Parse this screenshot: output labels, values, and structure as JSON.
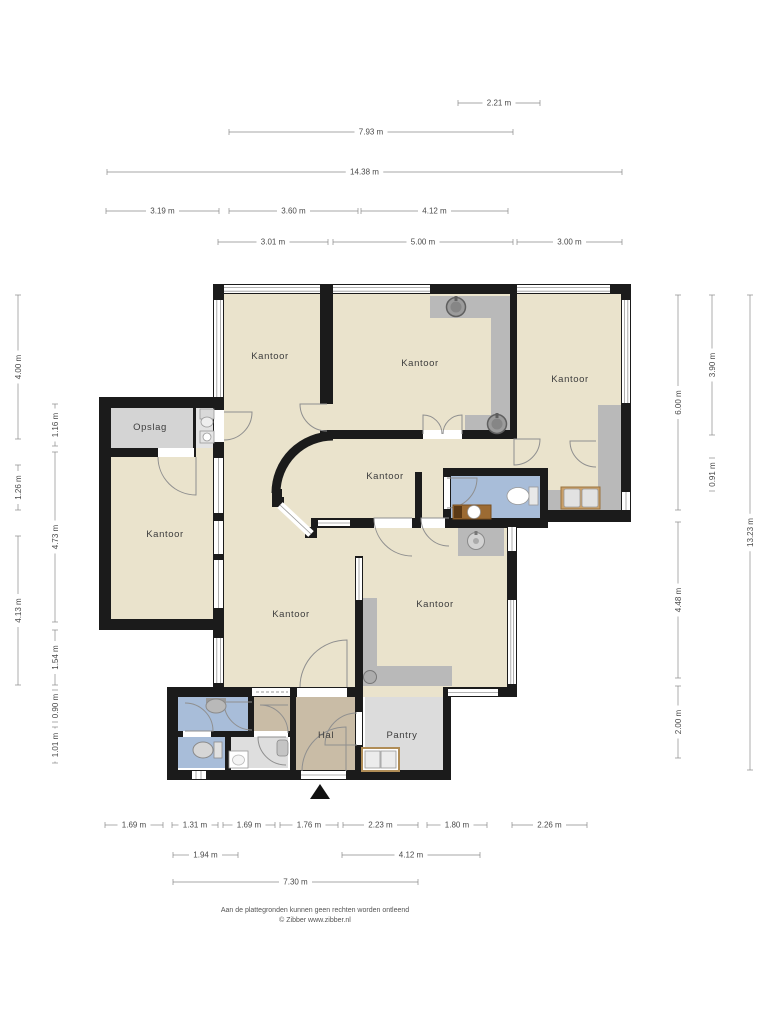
{
  "palette": {
    "wall": "#1b1b1b",
    "floor_office": "#eae3cc",
    "floor_storage": "#d4d4d4",
    "floor_zone": "#b9b9b9",
    "floor_wet": "#a8bdd9",
    "floor_hall": "#c9bca6",
    "floor_pantry": "#dcdcdc",
    "dim_line": "#8a8a8a",
    "dim_text": "#4a4a4a",
    "label_text": "#3d3d3d"
  },
  "rooms": [
    {
      "label": "Kantoor",
      "x": 270,
      "y": 359
    },
    {
      "label": "Kantoor",
      "x": 420,
      "y": 366
    },
    {
      "label": "Kantoor",
      "x": 570,
      "y": 382
    },
    {
      "label": "Kantoor",
      "x": 385,
      "y": 479
    },
    {
      "label": "Kantoor",
      "x": 165,
      "y": 537
    },
    {
      "label": "Kantoor",
      "x": 291,
      "y": 617
    },
    {
      "label": "Kantoor",
      "x": 435,
      "y": 607
    },
    {
      "label": "Opslag",
      "x": 150,
      "y": 430
    },
    {
      "label": "Hal",
      "x": 326,
      "y": 738
    },
    {
      "label": "Pantry",
      "x": 402,
      "y": 738
    }
  ],
  "dimensions": [
    {
      "label": "2.21 m",
      "orient": "h",
      "x1": 458,
      "x2": 540,
      "y": 103
    },
    {
      "label": "7.93 m",
      "orient": "h",
      "x1": 229,
      "x2": 513,
      "y": 132
    },
    {
      "label": "14.38 m",
      "orient": "h",
      "x1": 107,
      "x2": 622,
      "y": 172
    },
    {
      "label": "3.19 m",
      "orient": "h",
      "x1": 106,
      "x2": 219,
      "y": 211
    },
    {
      "label": "3.60 m",
      "orient": "h",
      "x1": 229,
      "x2": 358,
      "y": 211
    },
    {
      "label": "4.12 m",
      "orient": "h",
      "x1": 361,
      "x2": 508,
      "y": 211
    },
    {
      "label": "3.01 m",
      "orient": "h",
      "x1": 218,
      "x2": 328,
      "y": 242
    },
    {
      "label": "5.00 m",
      "orient": "h",
      "x1": 333,
      "x2": 513,
      "y": 242
    },
    {
      "label": "3.00 m",
      "orient": "h",
      "x1": 517,
      "x2": 622,
      "y": 242
    },
    {
      "label": "1.69 m",
      "orient": "h",
      "x1": 105,
      "x2": 163,
      "y": 825
    },
    {
      "label": "1.31 m",
      "orient": "h",
      "x1": 172,
      "x2": 218,
      "y": 825
    },
    {
      "label": "1.69 m",
      "orient": "h",
      "x1": 223,
      "x2": 275,
      "y": 825
    },
    {
      "label": "1.76 m",
      "orient": "h",
      "x1": 280,
      "x2": 338,
      "y": 825
    },
    {
      "label": "2.23 m",
      "orient": "h",
      "x1": 343,
      "x2": 418,
      "y": 825
    },
    {
      "label": "1.80 m",
      "orient": "h",
      "x1": 427,
      "x2": 487,
      "y": 825
    },
    {
      "label": "2.26 m",
      "orient": "h",
      "x1": 512,
      "x2": 587,
      "y": 825
    },
    {
      "label": "1.94 m",
      "orient": "h",
      "x1": 173,
      "x2": 238,
      "y": 855
    },
    {
      "label": "4.12 m",
      "orient": "h",
      "x1": 342,
      "x2": 480,
      "y": 855
    },
    {
      "label": "7.30 m",
      "orient": "h",
      "x1": 173,
      "x2": 418,
      "y": 882
    },
    {
      "label": "4.00 m",
      "orient": "v",
      "x": 18,
      "y1": 295,
      "y2": 439
    },
    {
      "label": "1.26 m",
      "orient": "v",
      "x": 18,
      "y1": 465,
      "y2": 510
    },
    {
      "label": "4.13 m",
      "orient": "v",
      "x": 18,
      "y1": 536,
      "y2": 685
    },
    {
      "label": "1.16 m",
      "orient": "v",
      "x": 55,
      "y1": 404,
      "y2": 446
    },
    {
      "label": "4.73 m",
      "orient": "v",
      "x": 55,
      "y1": 452,
      "y2": 622
    },
    {
      "label": "1.54 m",
      "orient": "v",
      "x": 55,
      "y1": 630,
      "y2": 685
    },
    {
      "label": "0.90 m",
      "orient": "v",
      "x": 55,
      "y1": 690,
      "y2": 722
    },
    {
      "label": "1.01 m",
      "orient": "v",
      "x": 55,
      "y1": 727,
      "y2": 763
    },
    {
      "label": "6.00 m",
      "orient": "v",
      "x": 678,
      "y1": 295,
      "y2": 510
    },
    {
      "label": "4.48 m",
      "orient": "v",
      "x": 678,
      "y1": 522,
      "y2": 678
    },
    {
      "label": "2.00 m",
      "orient": "v",
      "x": 678,
      "y1": 686,
      "y2": 758
    },
    {
      "label": "3.90 m",
      "orient": "v",
      "x": 712,
      "y1": 295,
      "y2": 435
    },
    {
      "label": "0.91 m",
      "orient": "v",
      "x": 712,
      "y1": 458,
      "y2": 491
    },
    {
      "label": "13.23 m",
      "orient": "v",
      "x": 750,
      "y1": 295,
      "y2": 770
    }
  ],
  "footer": {
    "line1": "Aan de plattegronden kunnen geen rechten worden ontleend",
    "line2": "© Zibber www.zibber.nl"
  }
}
